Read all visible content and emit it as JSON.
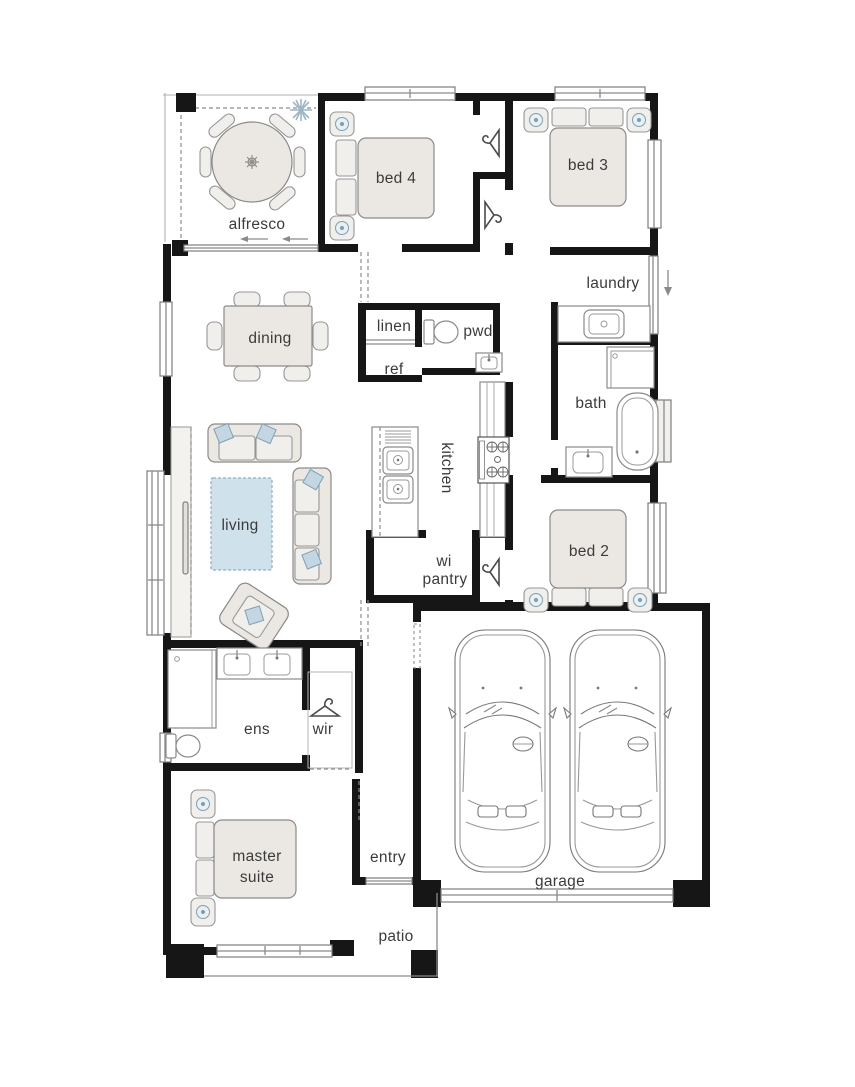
{
  "plan": {
    "rooms": {
      "alfresco": "alfresco",
      "bed4": "bed 4",
      "bed3": "bed 3",
      "laundry": "laundry",
      "dining": "dining",
      "linen": "linen",
      "pwd": "pwd",
      "ref": "ref",
      "bath": "bath",
      "living": "living",
      "kitchen": "kitchen",
      "wi_pantry_line1": "wi",
      "wi_pantry_line2": "pantry",
      "bed2": "bed 2",
      "ens": "ens",
      "wir": "wir",
      "master_line1": "master",
      "master_line2": "suite",
      "entry": "entry",
      "garage": "garage",
      "patio": "patio"
    },
    "colors": {
      "wall": "#161616",
      "furniture_fill": "#ebe8e3",
      "accent_blue": "#c3d6e1",
      "rug_blue": "#cfe1ea",
      "line_grey": "#8a8a8a",
      "text": "#3b3b3b"
    }
  }
}
